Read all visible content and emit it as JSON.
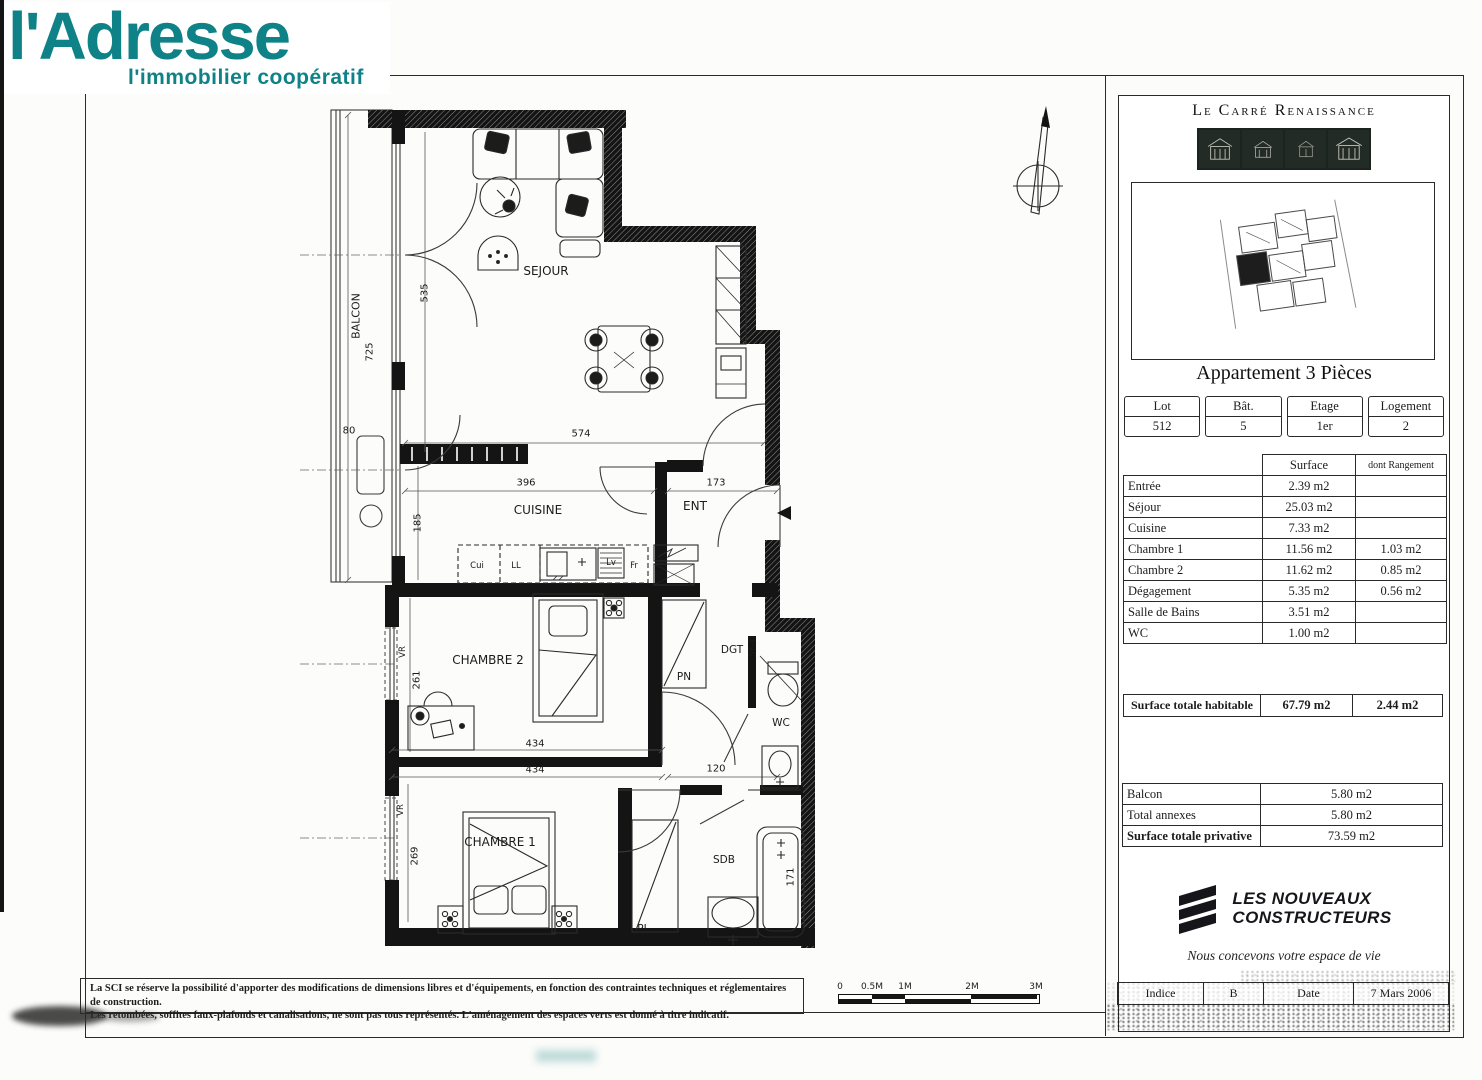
{
  "brand": {
    "name": "l'Adresse",
    "tagline": "l'immobilier coopératif",
    "color": "#0e8287"
  },
  "panel": {
    "project_title": "Le Carré Renaissance",
    "apartment_title": "Appartement 3 Pièces",
    "lot_table": {
      "cells": [
        {
          "label": "Lot",
          "value": "512"
        },
        {
          "label": "Bât.",
          "value": "5"
        },
        {
          "label": "Etage",
          "value": "1er"
        },
        {
          "label": "Logement",
          "value": "2"
        }
      ]
    },
    "surface_table": {
      "surface_header": "Surface",
      "rangement_header": "dont Rangement",
      "rows": [
        {
          "label": "Entrée",
          "surface": "2.39 m2",
          "rangement": ""
        },
        {
          "label": "Séjour",
          "surface": "25.03 m2",
          "rangement": ""
        },
        {
          "label": "Cuisine",
          "surface": "7.33 m2",
          "rangement": ""
        },
        {
          "label": "Chambre 1",
          "surface": "11.56 m2",
          "rangement": "1.03 m2"
        },
        {
          "label": "Chambre 2",
          "surface": "11.62 m2",
          "rangement": "0.85 m2"
        },
        {
          "label": "Dégagement",
          "surface": "5.35 m2",
          "rangement": "0.56 m2"
        },
        {
          "label": "Salle de Bains",
          "surface": "3.51 m2",
          "rangement": ""
        },
        {
          "label": "WC",
          "surface": "1.00 m2",
          "rangement": ""
        }
      ],
      "total": {
        "label": "Surface totale habitable",
        "surface": "67.79 m2",
        "rangement": "2.44 m2"
      }
    },
    "annex_table": {
      "rows": [
        {
          "label": "Balcon",
          "value": "5.80 m2"
        },
        {
          "label": "Total annexes",
          "value": "5.80 m2"
        },
        {
          "label": "Surface totale privative",
          "value": "73.59 m2"
        }
      ]
    },
    "builder": {
      "name_line1": "LES NOUVEAUX",
      "name_line2": "CONSTRUCTEURS",
      "tagline": "Nous concevons votre espace de vie"
    },
    "revision": {
      "indice_label": "Indice",
      "indice_value": "B",
      "date_label": "Date",
      "date_value": "7 Mars 2006"
    }
  },
  "plan": {
    "rooms": {
      "balcon": "BALCON",
      "sejour": "SEJOUR",
      "cuisine": "CUISINE",
      "ent": "ENT",
      "chambre2": "CHAMBRE 2",
      "chambre1": "CHAMBRE 1",
      "dgt": "DGT",
      "wc": "WC",
      "sdb": "SDB"
    },
    "closets": {
      "pn": "PN",
      "pi": "PI"
    },
    "shutter": "VR",
    "appliances": {
      "cui": "Cui",
      "ll": "LL",
      "lv": "Lv",
      "fr": "Fr"
    },
    "dims": {
      "balcon_length": "725",
      "d80": "80",
      "sejour_width": "574",
      "sejour_height": "535",
      "cuisine_width": "396",
      "ent_width": "173",
      "cuisine_height": "185",
      "chambre2_width": "434",
      "chambre1_width": "434",
      "couloir": "120",
      "chambre2_height": "261",
      "chambre1_height": "269",
      "dgt_height": "564",
      "baignoire": "171"
    }
  },
  "scalebar": {
    "labels": [
      "0",
      "0.5M",
      "1M",
      "2M",
      "3M"
    ]
  },
  "footer": {
    "disclaimer_line1": "La SCI se réserve la possibilité d'apporter des modifications de dimensions libres et d'équipements, en fonction des contraintes techniques et réglementaires de construction.",
    "disclaimer_line2": "Les retombées, soffites faux-plafonds et canalisations, ne sont pas tous représentés. L'aménagement des espaces verts est donné à titre indicatif."
  }
}
